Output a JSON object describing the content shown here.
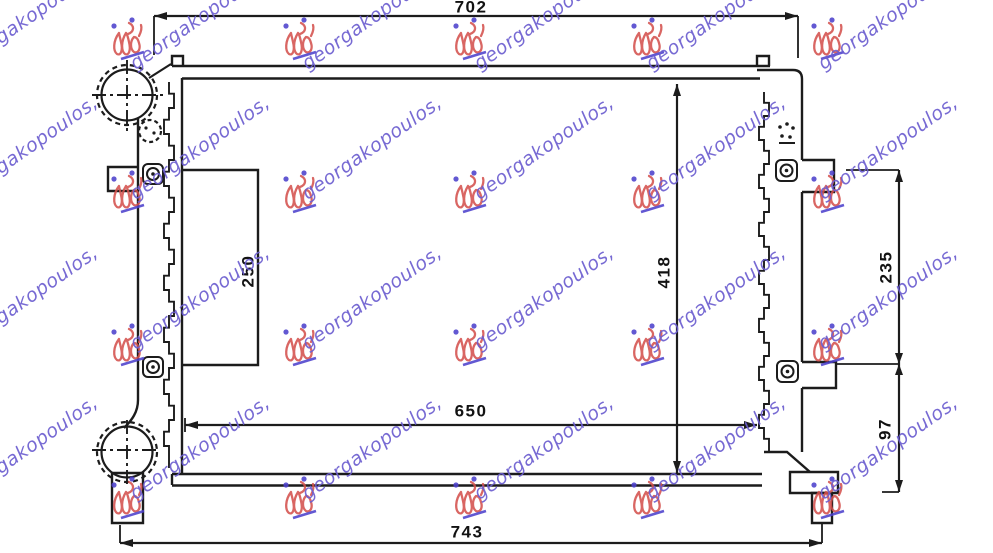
{
  "dimensions": {
    "top_width": "702",
    "bottom_width": "743",
    "core_width": "650",
    "core_height": "418",
    "left_bracket_span": "250",
    "right_upper_span": "235",
    "right_lower_span": "97"
  },
  "watermark": {
    "text": "georgakopoulos,",
    "text_color": "#6c5ed0",
    "logo_color": "#d4524e",
    "logo_dot_color": "#4d41cc",
    "text_rotation_deg": -35,
    "text_xs": [
      28,
      200,
      372,
      544,
      716,
      888
    ],
    "text_ys": [
      18,
      148,
      298,
      448
    ],
    "logo_xs": [
      128,
      300,
      470,
      648,
      828
    ],
    "logo_ys": [
      40,
      193,
      346,
      499
    ]
  },
  "drawing": {
    "line_color": "#1c1c1c",
    "background_color": "#ffffff"
  }
}
